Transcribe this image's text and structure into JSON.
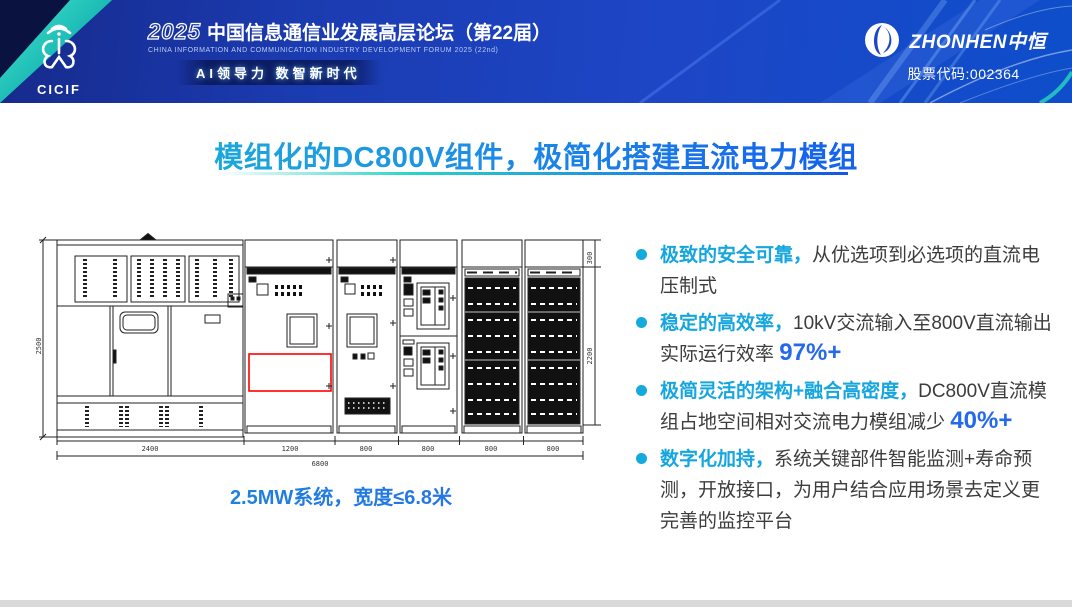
{
  "header": {
    "logo": {
      "acronym": "CICIF"
    },
    "forum": {
      "year": "2025",
      "title_cn": "中国信息通信业发展高层论坛（第22届）",
      "title_en": "CHINA INFORMATION AND COMMUNICATION INDUSTRY DEVELOPMENT FORUM 2025 (22nd)",
      "tagline": "AI领导力 数智新时代"
    },
    "company": {
      "name": "ZHONHEN中恒",
      "stock": "股票代码:002364"
    }
  },
  "slide": {
    "title": "模组化的DC800V组件，极简化搭建直流电力模组",
    "caption": "2.5MW系统，宽度≤6.8米",
    "bullets": [
      {
        "lead": "极致的安全可靠，",
        "text": "从优选项到必选项的直流电压制式",
        "highlight": ""
      },
      {
        "lead": "稳定的高效率，",
        "text": "10kV交流输入至800V直流输出实际运行效率 ",
        "highlight": "97%+"
      },
      {
        "lead": "极简灵活的架构+融合高密度，",
        "text": "DC800V直流模组占地空间相对交流电力模组减少 ",
        "highlight": "40%+"
      },
      {
        "lead": "数字化加持，",
        "text": "系统关键部件智能监测+寿命预测，开放接口，为用户结合应用场景去定义更完善的监控平台",
        "highlight": ""
      }
    ],
    "drawing": {
      "dim_left": "2500",
      "dim_right": "2200",
      "dim_top_right": "300",
      "dims_bottom": [
        "2400",
        "1200",
        "800",
        "800",
        "800",
        "800"
      ],
      "dim_total": "6800"
    }
  },
  "colors": {
    "accent_cyan": "#16a6df",
    "accent_blue": "#2468ec",
    "red_highlight": "#ff0000",
    "header_blue": "#1d46c6",
    "teal": "#2ad4c4"
  }
}
